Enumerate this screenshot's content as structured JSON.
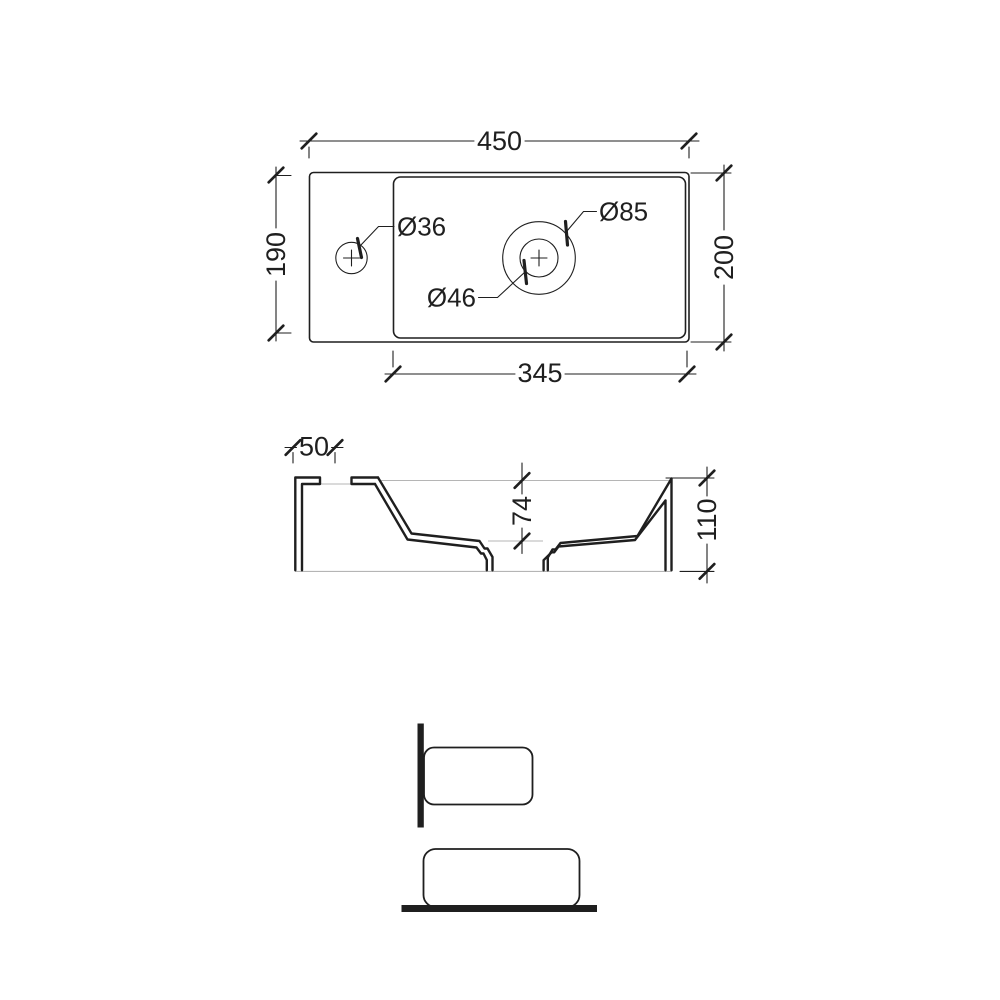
{
  "drawing": {
    "title": "washbasin-dimension-drawing",
    "top_view": {
      "width_label": "450",
      "left_depth_label": "190",
      "right_depth_label": "200",
      "basin_width_label": "345",
      "tap_hole_label": "Ø36",
      "drain_outer_label": "Ø85",
      "drain_hole_label": "Ø46"
    },
    "section_view": {
      "tap_offset_label": "50",
      "basin_depth_label": "74",
      "overall_height_label": "110"
    },
    "colors": {
      "line": "#1f1f1f",
      "faint_line": "#b5b5b5",
      "background": "#ffffff"
    }
  }
}
